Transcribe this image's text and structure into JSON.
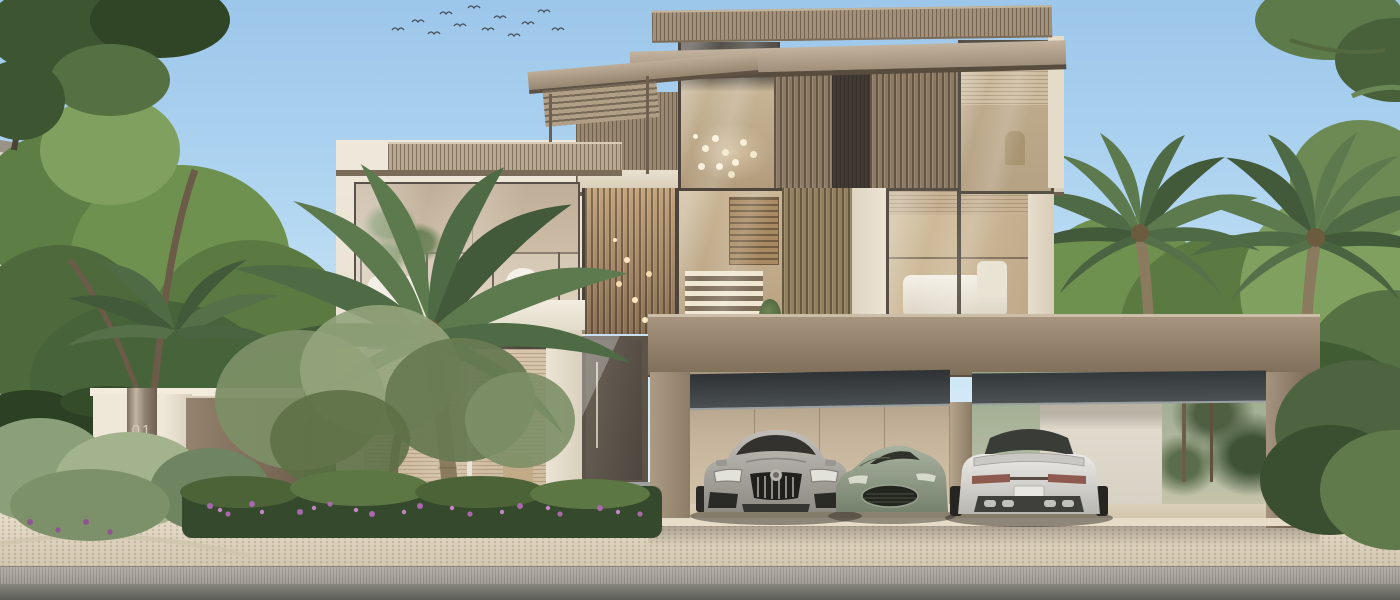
{
  "scene": {
    "type": "exterior-architectural-render",
    "description": "Three-storey modern luxury villa in cream stone with bronze timber slat screens, glass balcony, open three-car garage with parked cars, date palms and landscaped beds, paved driveway and street in the foreground",
    "sky": "clear blue day sky with a flock of birds",
    "signage": {
      "unit_number": "01"
    },
    "cars": [
      {
        "position": "left",
        "color": "silver-grey",
        "view": "front"
      },
      {
        "position": "center",
        "color": "sage-green",
        "view": "front-three-quarter"
      },
      {
        "position": "right",
        "color": "pearl-white",
        "view": "rear"
      }
    ]
  },
  "palette": {
    "sky_top": "#9cc6ea",
    "sky_horizon": "#e8f2f6",
    "bronze_slat": "#8d7a66",
    "cream_stone": "#e9e1d2",
    "wood_wall": "#94805f",
    "glass_interior": "#cdbba4",
    "garage_wall": "#c6b59c",
    "paver": "#d9cfbf",
    "road": "#6e6e6a",
    "foliage_dark": "#3f5c32",
    "foliage_light": "#7fa05e",
    "car_silver": "#a8a49e",
    "car_green": "#8a9584",
    "car_white": "#dcdcd8"
  }
}
